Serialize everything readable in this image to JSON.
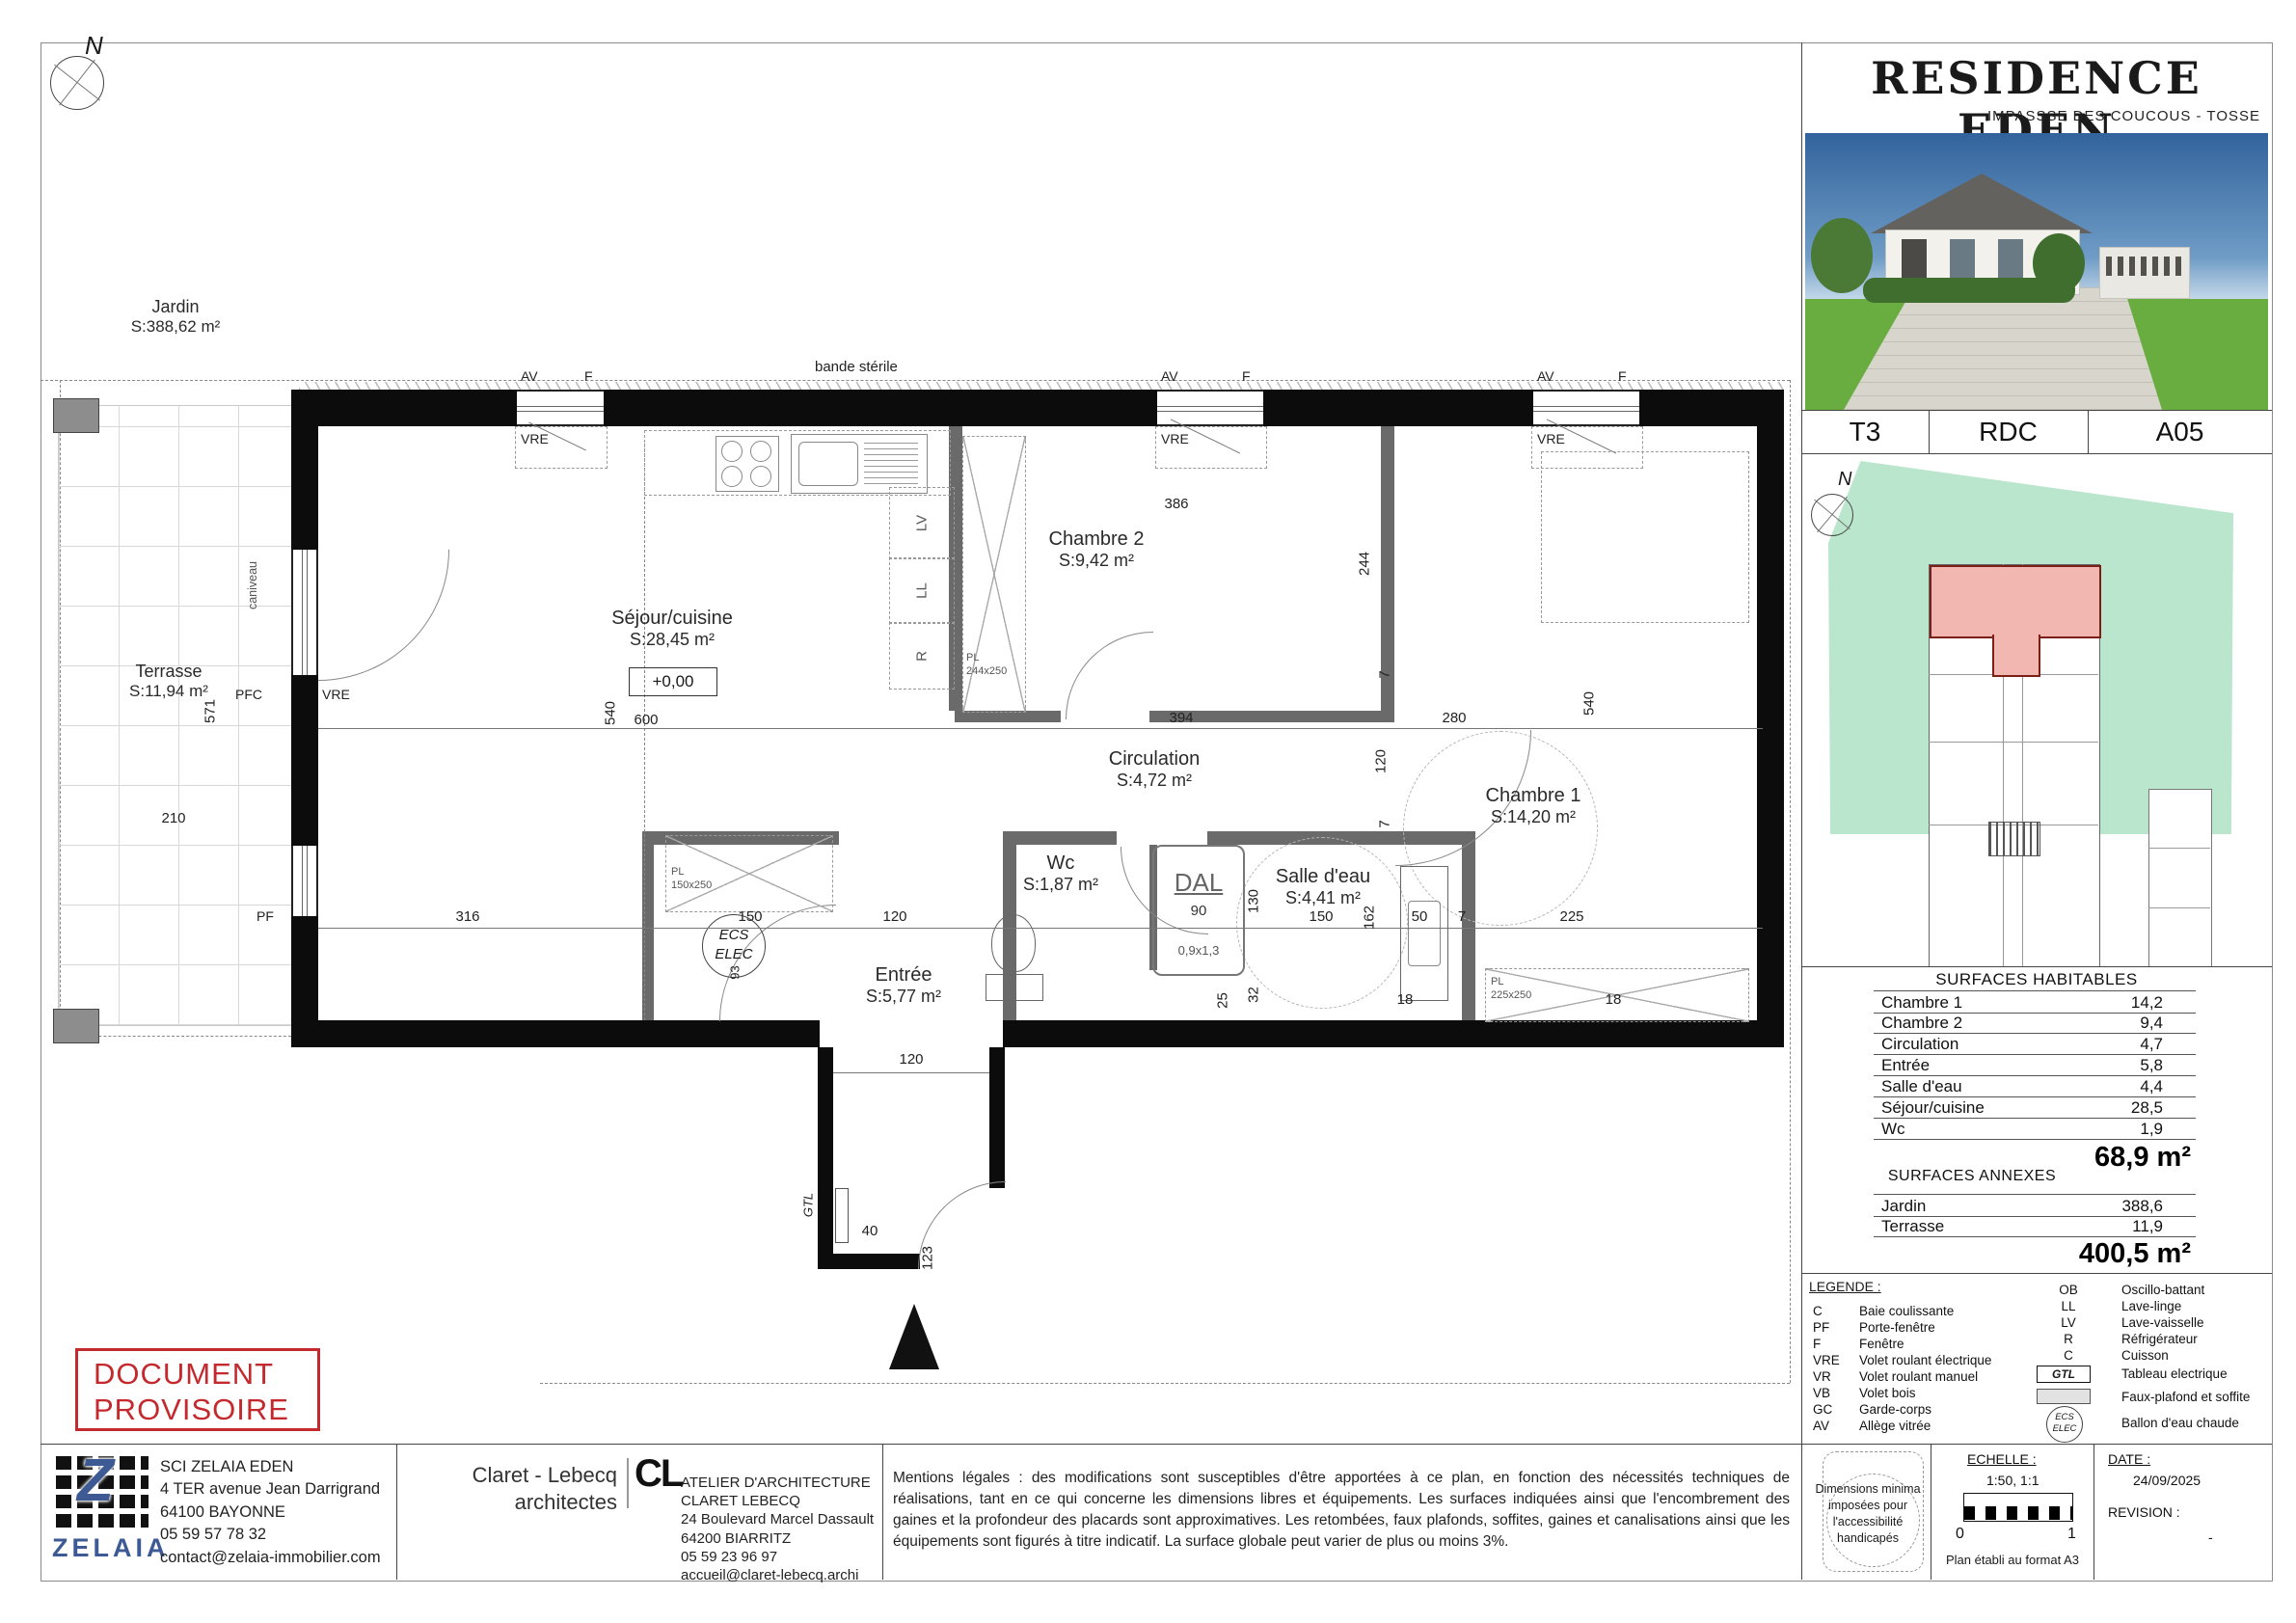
{
  "sheet": {
    "title": "RESIDENCE EDEN",
    "subtitle": "IMPASSSE DES COUCOUS - TOSSE"
  },
  "unit_row": {
    "type": "T3",
    "floor": "RDC",
    "number": "A05"
  },
  "surfaces_habitables": {
    "heading": "SURFACES HABITABLES",
    "rows": [
      {
        "label": "Chambre 1",
        "value": "14,2"
      },
      {
        "label": "Chambre 2",
        "value": "9,4"
      },
      {
        "label": "Circulation",
        "value": "4,7"
      },
      {
        "label": "Entrée",
        "value": "5,8"
      },
      {
        "label": "Salle d'eau",
        "value": "4,4"
      },
      {
        "label": "Séjour/cuisine",
        "value": "28,5"
      },
      {
        "label": "Wc",
        "value": "1,9"
      }
    ],
    "total": "68,9 m²"
  },
  "surfaces_annexes": {
    "heading": "SURFACES ANNEXES",
    "rows": [
      {
        "label": "Jardin",
        "value": "388,6"
      },
      {
        "label": "Terrasse",
        "value": "11,9"
      }
    ],
    "total": "400,5 m²"
  },
  "legend": {
    "heading": "LEGENDE :",
    "items_left": [
      {
        "abbr": "C",
        "label": "Baie coulissante"
      },
      {
        "abbr": "PF",
        "label": "Porte-fenêtre"
      },
      {
        "abbr": "F",
        "label": "Fenêtre"
      },
      {
        "abbr": "VRE",
        "label": "Volet roulant électrique"
      },
      {
        "abbr": "VR",
        "label": "Volet roulant manuel"
      },
      {
        "abbr": "VB",
        "label": "Volet bois"
      },
      {
        "abbr": "GC",
        "label": "Garde-corps"
      },
      {
        "abbr": "AV",
        "label": "Allège vitrée"
      }
    ],
    "items_right": [
      {
        "abbr": "OB",
        "label": "Oscillo-battant"
      },
      {
        "abbr": "LL",
        "label": "Lave-linge"
      },
      {
        "abbr": "LV",
        "label": "Lave-vaisselle"
      },
      {
        "abbr": "R",
        "label": "Réfrigérateur"
      },
      {
        "abbr": "C",
        "label": "Cuisson"
      }
    ],
    "gtl_abbr": "GTL",
    "gtl_label": "Tableau electrique",
    "faux_plafond_label": "Faux-plafond et soffite",
    "ecs_line1": "ECS",
    "ecs_line2": "ELEC",
    "ecs_label": "Ballon d'eau chaude"
  },
  "footer": {
    "accessibility_line1": "Dimensions minima",
    "accessibility_line2": "imposées pour",
    "accessibility_line3": "l'accessibilité handicapés",
    "echelle_label": "ECHELLE :",
    "echelle_value": "1:50, 1:1",
    "scale_zero": "0",
    "scale_one": "1",
    "format_note": "Plan établi au format A3",
    "date_label": "DATE :",
    "date_value": "24/09/2025",
    "revision_label": "REVISION :",
    "revision_value": "-"
  },
  "developer": {
    "logo_text": "Z",
    "wordmark": "ZELAIA",
    "name": "SCI ZELAIA EDEN",
    "address": "4 TER avenue Jean Darrigrand 64100 BAYONNE",
    "phone": "05 59 57 78 32",
    "email": "contact@zelaia-immobilier.com"
  },
  "architect": {
    "brand_line1": "Claret - Lebecq",
    "brand_line2": "architectes",
    "logo_text": "CL",
    "name": "ATELIER D'ARCHITECTURE CLARET LEBECQ",
    "address": "24 Boulevard Marcel Dassault",
    "city": "64200 BIARRITZ",
    "phone": "05 59 23 96 97",
    "email": "accueil@claret-lebecq.archi"
  },
  "legal_text": "Mentions légales : des modifications sont susceptibles d'être apportées à ce plan, en fonction des nécessités techniques de réalisations, tant en ce qui concerne les dimensions libres et équipements. Les surfaces indiquées ainsi que l'encombrement des gaines et la profondeur des placards sont approximatives. Les retombées, faux plafonds, soffites, gaines et canalisations ainsi que les équipements sont figurés à titre indicatif. La surface globale peut varier de plus ou moins 3%.",
  "stamp": {
    "line1": "DOCUMENT",
    "line2": "PROVISOIRE"
  },
  "plan": {
    "north": "N",
    "jardin": {
      "name": "Jardin",
      "area": "S:388,62 m²"
    },
    "bande_sterile": "bande stérile",
    "terrasse": {
      "name": "Terrasse",
      "area": "S:11,94 m²"
    },
    "caniveau": "caniveau",
    "level": "+0,00",
    "rooms": {
      "sejour": {
        "name": "Séjour/cuisine",
        "area": "S:28,45 m²"
      },
      "chambre2": {
        "name": "Chambre 2",
        "area": "S:9,42 m²"
      },
      "circulation": {
        "name": "Circulation",
        "area": "S:4,72 m²"
      },
      "chambre1": {
        "name": "Chambre 1",
        "area": "S:14,20 m²"
      },
      "wc": {
        "name": "Wc",
        "area": "S:1,87 m²"
      },
      "salle_eau": {
        "name": "Salle d'eau",
        "area": "S:4,41 m²"
      },
      "entree": {
        "name": "Entrée",
        "area": "S:5,77 m²"
      }
    },
    "win": {
      "av": "AV",
      "f": "F",
      "vre": "VRE",
      "pfc": "PFC",
      "pf": "PF"
    },
    "appliances": {
      "lv": "LV",
      "ll": "LL",
      "r": "R"
    },
    "closets": {
      "pl": "PL",
      "s1": "150x250",
      "s2": "244x250",
      "s3": "225x250"
    },
    "fixtures": {
      "dal": "DAL",
      "dal_size": "0,9x1,3",
      "ecs1": "ECS",
      "ecs2": "ELEC",
      "gtl": "GTL"
    },
    "dims": {
      "d386": "386",
      "d244": "244",
      "d394": "394",
      "d120c": "120",
      "d280": "280",
      "d540l": "540",
      "d540r": "540",
      "d600": "600",
      "d210": "210",
      "d571": "571",
      "d316": "316",
      "d150a": "150",
      "d120a": "120",
      "d90": "90",
      "d130": "130",
      "d150b": "150",
      "d162": "162",
      "d50": "50",
      "d7a": "7",
      "d7b": "7",
      "d7c": "7",
      "d225": "225",
      "d32": "32",
      "d25": "25",
      "d18a": "18",
      "d18b": "18",
      "d120b": "120",
      "d40": "40",
      "d123": "123",
      "d93": "93"
    }
  },
  "colors": {
    "accent_red": "#c4292e",
    "zelaia_blue": "#3d5a94",
    "site_green": "#b9e6cc",
    "unit_red_fill": "#f3b7b1",
    "unit_red_border": "#7c2017"
  }
}
